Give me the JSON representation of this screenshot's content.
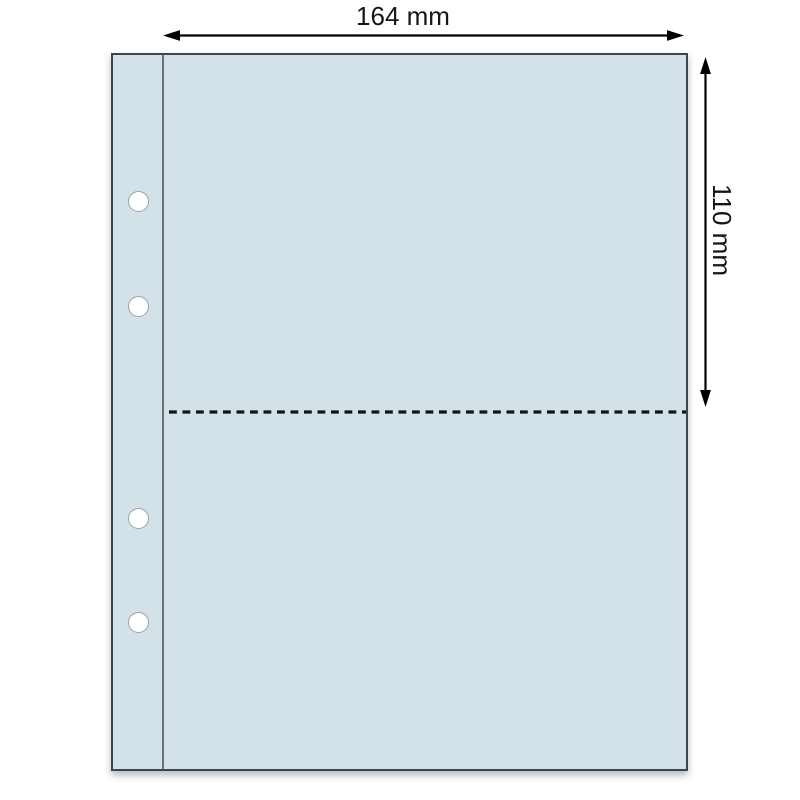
{
  "diagram": {
    "subject": "binder pocket page with two pockets and four binding holes",
    "width_dimension": {
      "label": "164 mm"
    },
    "height_dimension": {
      "label": "110 mm"
    },
    "sheet": {
      "fill_color": "#d3e2e9",
      "border_color": "#3d464e",
      "binding_holes_count": "4",
      "pockets_count": "2"
    },
    "lines": {
      "dimension_arrow_color": "#000000",
      "divider_style": "dashed",
      "divider_color": "#141414",
      "binding_seam_color": "#4a545b"
    },
    "background_color": "#ffffff",
    "text_color": "#161616"
  }
}
